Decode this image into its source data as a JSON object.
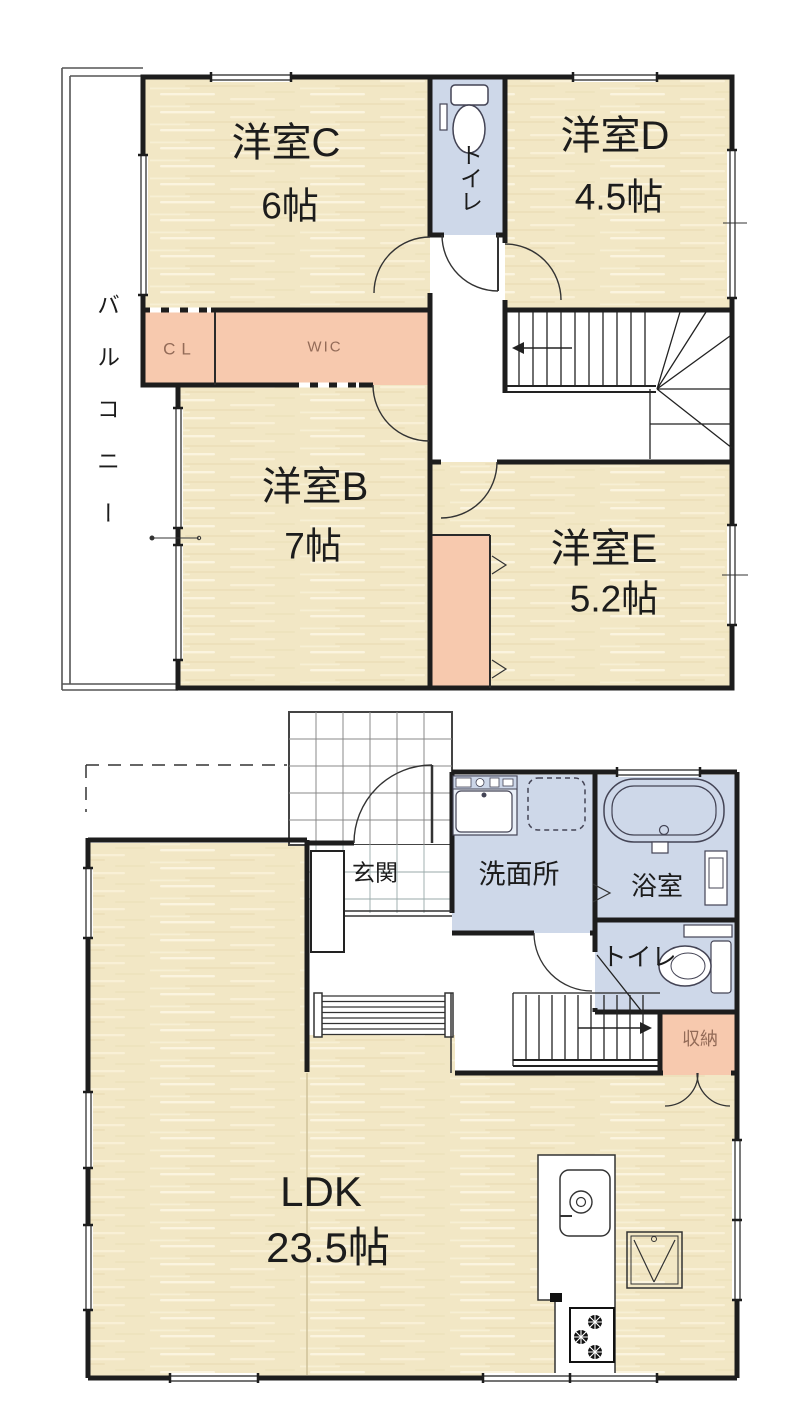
{
  "floor2": {
    "rooms": [
      {
        "name": "洋室C",
        "size": "6帖"
      },
      {
        "name": "洋室D",
        "size": "4.5帖"
      },
      {
        "name": "洋室B",
        "size": "7帖"
      },
      {
        "name": "洋室E",
        "size": "5.2帖"
      }
    ],
    "toilet": "トイレ",
    "closet": "CL",
    "walk_in_closet": "WIC",
    "balcony": "バルコニー"
  },
  "floor1": {
    "entrance": "玄関",
    "washroom": "洗面所",
    "bathroom": "浴室",
    "toilet": "トイレ",
    "storage": "収納",
    "ldk": {
      "name": "LDK",
      "size": "23.5帖"
    }
  },
  "palette": {
    "floor_wood": "#f2e7c5",
    "closet_salmon": "#f7c9ae",
    "wet_blue": "#ced8e9",
    "wall": "#1d1d1d",
    "label_brown": "#936b58"
  }
}
